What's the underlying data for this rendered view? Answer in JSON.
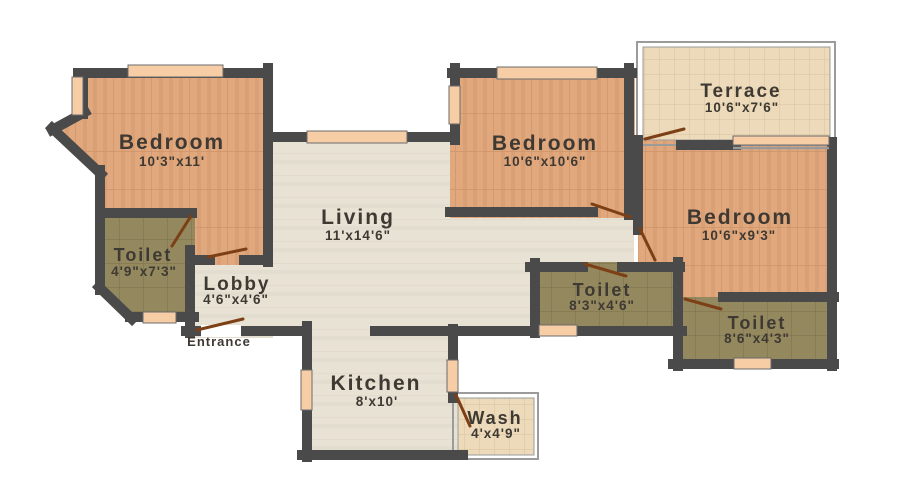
{
  "plan": {
    "colors": {
      "wall": "#4a4a4a",
      "bedroom_floor": "#e2a87d",
      "toilet_floor": "#94885f",
      "living_floor": "#e8e2d4",
      "terrace_floor": "#ecdaba",
      "window": "#f6cda4",
      "door_swing": "#7c3f16",
      "label_text": "#3e3933"
    },
    "rooms": {
      "bedroom_top_left": {
        "name": "Bedroom",
        "dims": "10'3\"x11'"
      },
      "toilet_left": {
        "name": "Toilet",
        "dims": "4'9\"x7'3\""
      },
      "lobby": {
        "name": "Lobby",
        "dims": "4'6\"x4'6\""
      },
      "living": {
        "name": "Living",
        "dims": "11'x14'6\""
      },
      "kitchen": {
        "name": "Kitchen",
        "dims": "8'x10'"
      },
      "wash": {
        "name": "Wash",
        "dims": "4'x4'9\""
      },
      "bedroom_top_middle": {
        "name": "Bedroom",
        "dims": "10'6\"x10'6\""
      },
      "terrace": {
        "name": "Terrace",
        "dims": "10'6\"x7'6\""
      },
      "bedroom_right": {
        "name": "Bedroom",
        "dims": "10'6\"x9'3\""
      },
      "toilet_center": {
        "name": "Toilet",
        "dims": "8'3\"x4'6\""
      },
      "toilet_right": {
        "name": "Toilet",
        "dims": "8'6\"x4'3\""
      }
    },
    "labels": {
      "entrance": "Entrance"
    }
  }
}
